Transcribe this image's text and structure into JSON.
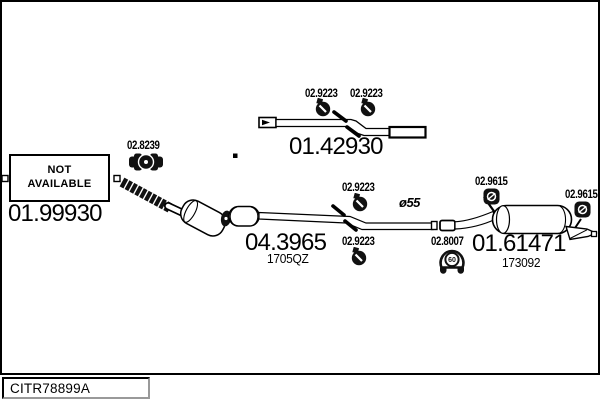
{
  "drawing_code": "CITR78899A",
  "not_available_box": {
    "line1": "NOT",
    "line2": "AVAILABLE"
  },
  "parts": {
    "front_pipe": {
      "number": "01.99930"
    },
    "clamp_8239": {
      "number": "02.8239"
    },
    "center_pipe": {
      "number": "01.42930"
    },
    "clamp_top_left": {
      "number": "02.9223"
    },
    "clamp_top_right": {
      "number": "02.9223"
    },
    "catalyst": {
      "number": "04.3965",
      "oe_ref": "1705QZ"
    },
    "clamp_mid_upper": {
      "number": "02.9223"
    },
    "clamp_mid_lower": {
      "number": "02.9223"
    },
    "pipe_diameter": {
      "note": "ø55"
    },
    "hanger_front": {
      "number": "02.9615"
    },
    "hanger_rear": {
      "number": "02.9615"
    },
    "mount_8007": {
      "number": "02.8007",
      "icon_text": "60"
    },
    "rear_muffler": {
      "number": "01.61471",
      "oe_ref": "173092"
    }
  },
  "colors": {
    "ink": "#000000",
    "background": "#ffffff"
  }
}
